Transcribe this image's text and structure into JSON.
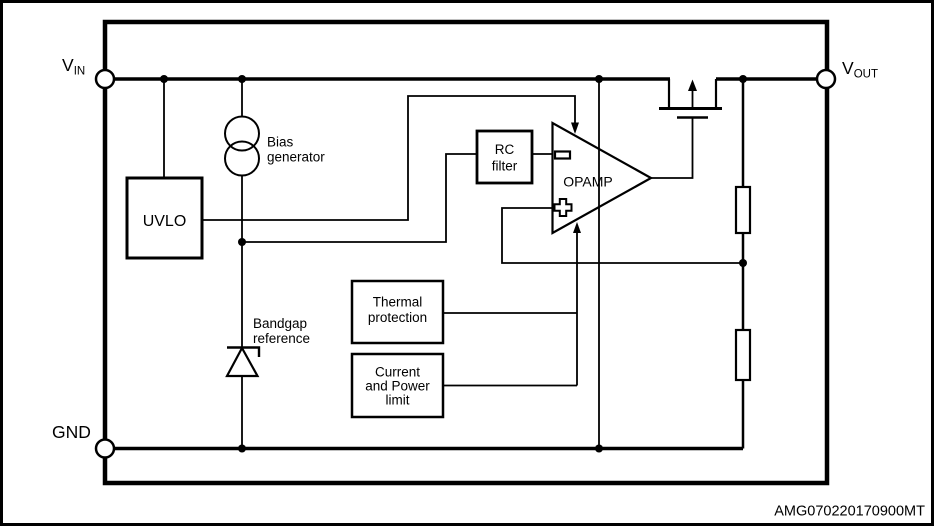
{
  "diagram": {
    "background": "#ffffff",
    "line_color": "#000000",
    "terminals": {
      "vin": {
        "name": "V",
        "sub": "IN"
      },
      "vout": {
        "name": "V",
        "sub": "OUT"
      },
      "gnd": {
        "name": "GND"
      }
    },
    "blocks": {
      "uvlo": {
        "label": "UVLO"
      },
      "bias_generator": {
        "lines": [
          "Bias",
          "generator"
        ]
      },
      "bandgap_reference": {
        "lines": [
          "Bandgap",
          "reference"
        ]
      },
      "rc_filter": {
        "lines": [
          "RC",
          "filter"
        ]
      },
      "opamp": {
        "label": "OPAMP"
      },
      "thermal_protection": {
        "lines": [
          "Thermal",
          "protection"
        ]
      },
      "current_power_limit": {
        "lines": [
          "Current",
          "and Power",
          "limit"
        ]
      }
    },
    "watermark": "AMG070220170900MT"
  }
}
